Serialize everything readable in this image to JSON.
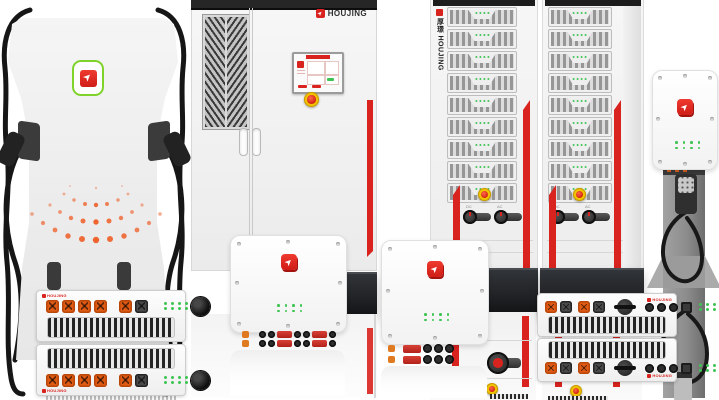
{
  "brand": {
    "name": "HOUJING",
    "name_cn": "厚璟",
    "vertical_label": "厚璟 HOUJING",
    "accent_red": "#d8231f",
    "logo_green": "#7fd32b"
  },
  "main_cabinet": {
    "brand_label": "HOUJING"
  },
  "rack_cabinet": {
    "side_label": "厚璟 HOUJING",
    "module_count": 9,
    "switch_labels": [
      "DC",
      "AC"
    ]
  },
  "power_unit": {
    "brand_label": "HOUJING"
  },
  "colors": {
    "background": "#ffffff",
    "cabinet_body": "#f2f2f2",
    "dark_base": "#26282b",
    "stripe_red": "#d8231f",
    "led_green": "#3fc453",
    "connector_orange": "#e05a14",
    "estop_yellow": "#f2c300",
    "estop_red": "#d0201a",
    "cable_black": "#161616"
  }
}
